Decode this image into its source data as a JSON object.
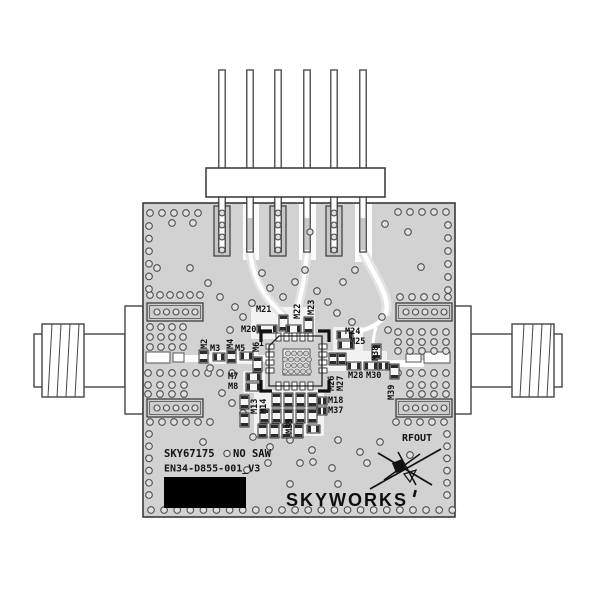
{
  "title": "SKY67175 evaluation board product image",
  "board": {
    "silkscreen": {
      "part_number": "SKY67175",
      "note": "NO SAW",
      "board_id": "EN34-D855-001_V3",
      "rf_output": "RFOUT",
      "pin1": "1"
    },
    "logo": {
      "text": "SKYWORKS"
    }
  },
  "components": [
    {
      "ref": "M21",
      "x": 256,
      "y": 312,
      "rot": 0
    },
    {
      "ref": "M22",
      "x": 300,
      "y": 319,
      "rot": -90
    },
    {
      "ref": "M23",
      "x": 314,
      "y": 315,
      "rot": -90
    },
    {
      "ref": "M20",
      "x": 241,
      "y": 332,
      "rot": 0
    },
    {
      "ref": "M2",
      "x": 207,
      "y": 349,
      "rot": -90
    },
    {
      "ref": "M3",
      "x": 210,
      "y": 351,
      "rot": 0
    },
    {
      "ref": "M4",
      "x": 233,
      "y": 349,
      "rot": -90
    },
    {
      "ref": "M5",
      "x": 235,
      "y": 351,
      "rot": 0
    },
    {
      "ref": "M6",
      "x": 259,
      "y": 352,
      "rot": -90
    },
    {
      "ref": "M7",
      "x": 228,
      "y": 379,
      "rot": 0
    },
    {
      "ref": "M8",
      "x": 228,
      "y": 389,
      "rot": 0
    },
    {
      "ref": "M24",
      "x": 345,
      "y": 334,
      "rot": 0
    },
    {
      "ref": "M25",
      "x": 350,
      "y": 344,
      "rot": 0
    },
    {
      "ref": "M38",
      "x": 378,
      "y": 361,
      "rot": -90
    },
    {
      "ref": "M26",
      "x": 334,
      "y": 391,
      "rot": -90
    },
    {
      "ref": "M27",
      "x": 343,
      "y": 391,
      "rot": -90
    },
    {
      "ref": "M28",
      "x": 348,
      "y": 378,
      "rot": 0
    },
    {
      "ref": "M30",
      "x": 366,
      "y": 378,
      "rot": 0
    },
    {
      "ref": "M39",
      "x": 394,
      "y": 400,
      "rot": -90
    },
    {
      "ref": "M13",
      "x": 257,
      "y": 414,
      "rot": -90
    },
    {
      "ref": "M14",
      "x": 266,
      "y": 414,
      "rot": -90
    },
    {
      "ref": "M18",
      "x": 328,
      "y": 403,
      "rot": 0
    },
    {
      "ref": "M37",
      "x": 328,
      "y": 413,
      "rot": 0
    },
    {
      "ref": "M39",
      "x": 292,
      "y": 434,
      "rot": -90
    }
  ],
  "colors": {
    "background": "#ffffff",
    "board": "#d2d2d2",
    "board_outline": "#3a3a3a",
    "silkscreen": "#141414",
    "trace": "#ffffff",
    "label_block": "#000000"
  }
}
